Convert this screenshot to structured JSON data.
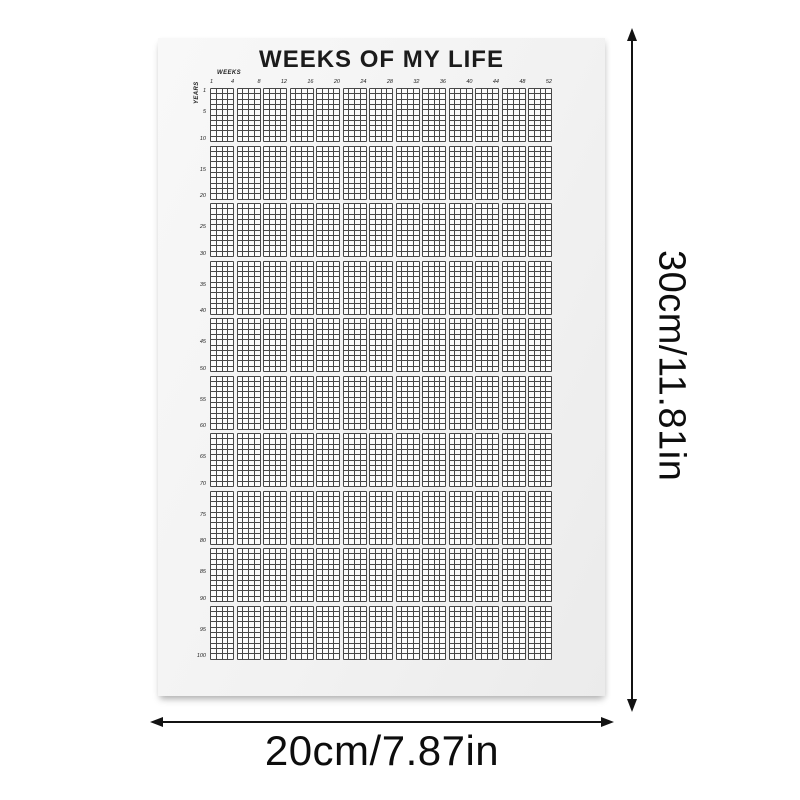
{
  "poster": {
    "title": "WEEKS OF MY LIFE",
    "weeks_axis_label": "WEEKS",
    "years_axis_label": "YEARS",
    "grid": {
      "total_years": 100,
      "weeks_per_year": 52,
      "groups": 13,
      "cols_per_group": 4,
      "blocks": 10,
      "rows_per_block": 10,
      "week_tick_labels": [
        1,
        4,
        8,
        12,
        16,
        20,
        24,
        28,
        32,
        36,
        40,
        44,
        48,
        52
      ],
      "year_tick_labels": [
        1,
        5,
        10,
        15,
        20,
        25,
        30,
        35,
        40,
        45,
        50,
        55,
        60,
        65,
        70,
        75,
        80,
        85,
        90,
        95,
        100
      ],
      "cell_fill_color": "#fbfbfb",
      "cell_line_color": "#474747"
    }
  },
  "dimension_annotations": {
    "height_label": "30cm/11.81in",
    "width_label": "20cm/7.87in",
    "arrow_color": "#131313"
  }
}
